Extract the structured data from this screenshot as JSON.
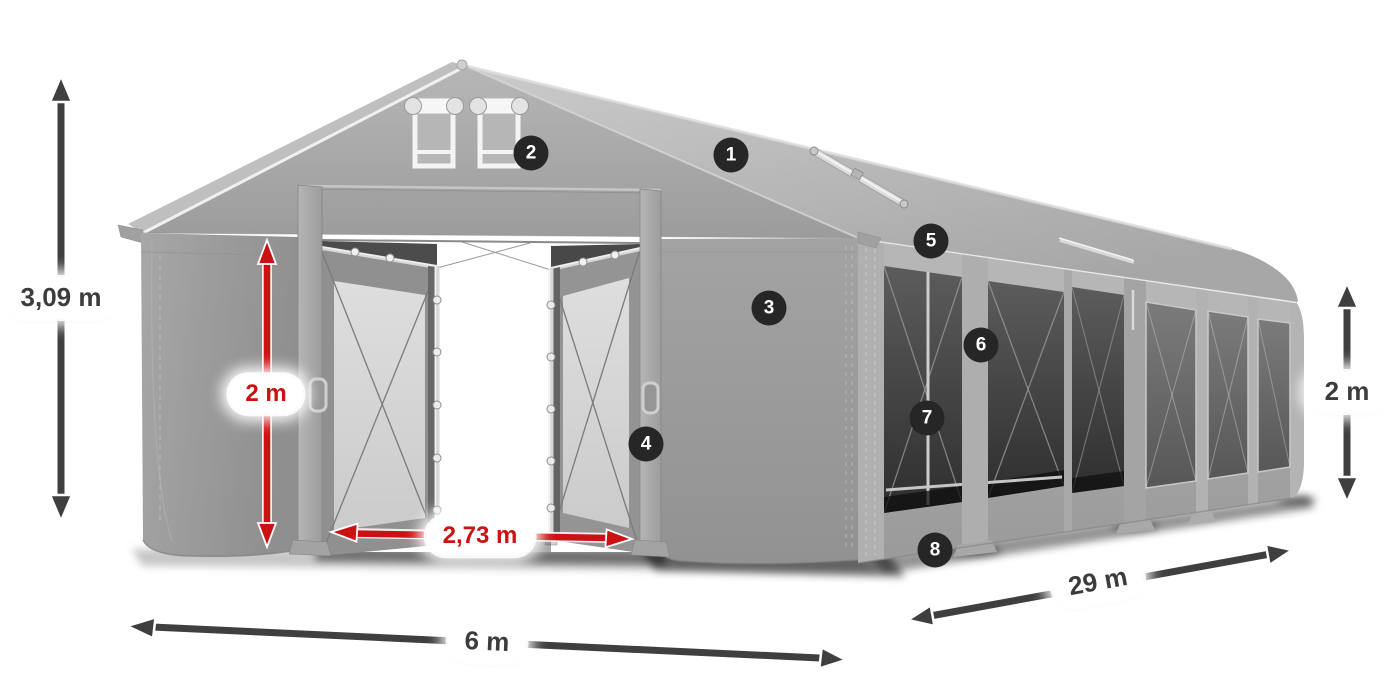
{
  "dimension_labels": {
    "total_height": "3,09 m",
    "entrance_height": "2 m",
    "entrance_width": "2,73 m",
    "width": "6 m",
    "length": "29 m",
    "side_wall_height": "2 m"
  },
  "markers": [
    {
      "label": "1"
    },
    {
      "label": "2"
    },
    {
      "label": "3"
    },
    {
      "label": "4"
    },
    {
      "label": "5"
    },
    {
      "label": "6"
    },
    {
      "label": "7"
    },
    {
      "label": "8"
    }
  ],
  "colors": {
    "background": "#ffffff",
    "dimension_dark": "#3f3f3f",
    "dimension_red": "#cc1114",
    "label_background": "#ffffff",
    "label_text_dark": "#3c3c3c",
    "label_text_red": "#cc1111",
    "marker_background": "#262626",
    "marker_text": "#ffffff",
    "tent_fabric": "#a4a4a4",
    "tent_roof": "#c4c4c4",
    "mesh_panel": "#3f3f3f",
    "frame_silver": "#d6d6d6"
  }
}
